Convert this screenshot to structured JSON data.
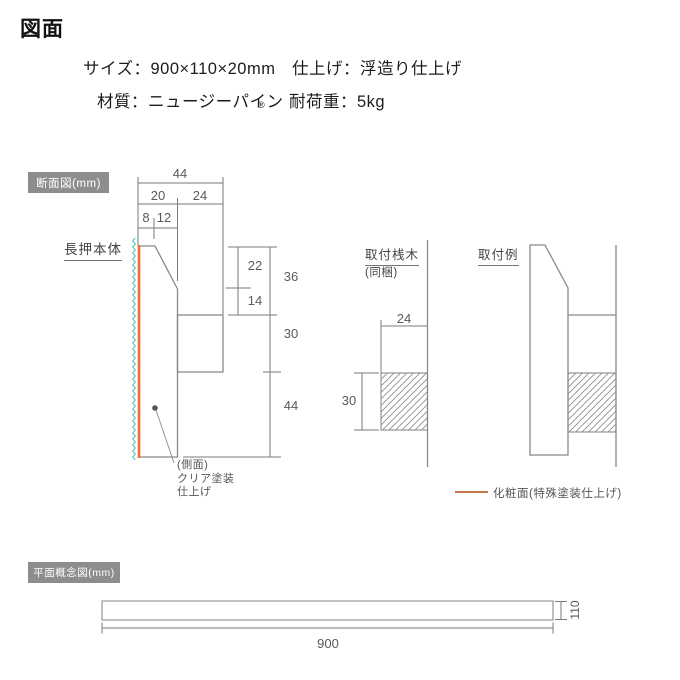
{
  "page": {
    "title": "図面"
  },
  "specs": {
    "size": "サイズ：900×110×20mm",
    "finish": "仕上げ：浮造り仕上げ",
    "material": "材質：ニュージーパイン",
    "material_mark": "®",
    "load": "耐荷重：5kg"
  },
  "cross_section": {
    "section_label": "断面図(mm)",
    "body_label": "長押本体",
    "dims": {
      "total_depth": "44",
      "front_depth": "20",
      "back_depth": "24",
      "top_flat": "8",
      "chamfer_run": "12",
      "upper_chamfer": "22",
      "upper_straight": "14",
      "upper_total": "36",
      "middle": "30",
      "lower": "44"
    },
    "side_note": {
      "line1": "(側面)",
      "line2": "クリア塗装",
      "line3": "仕上げ"
    }
  },
  "batten": {
    "label": "取付桟木",
    "sub_label": "(同梱)",
    "dims": {
      "width": "24",
      "height": "30"
    }
  },
  "example": {
    "label": "取付例"
  },
  "legend": {
    "label": "化粧面(特殊塗装仕上げ)"
  },
  "plan": {
    "section_label": "平面概念図(mm)",
    "dims": {
      "length": "900",
      "width": "110"
    }
  },
  "colors": {
    "front_face_line": "#ef6d35",
    "side_wavy_line": "#4cc8b8",
    "legend_line": "#c9764f",
    "section_box": "#8d8d8d"
  }
}
